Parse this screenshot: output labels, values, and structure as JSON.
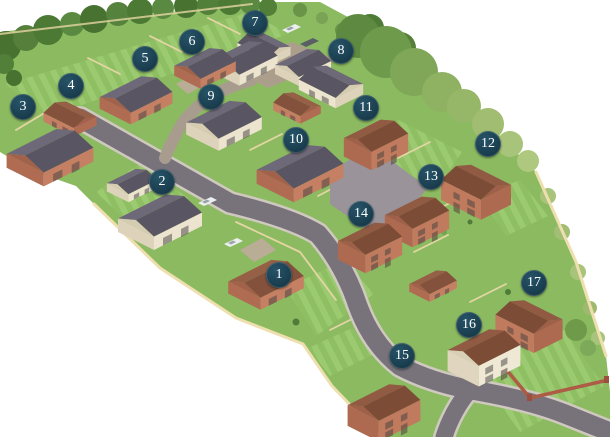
{
  "canvas": {
    "width": 610,
    "height": 437,
    "background": "#ffffff"
  },
  "site_plan": {
    "marker_style": {
      "shape": "circle",
      "diameter_px": 26,
      "background": "#1b4152",
      "highlight": "#275468",
      "rim": "#132f3c",
      "text_color": "#ffffff"
    },
    "plots": [
      {
        "number": "1",
        "x": 279,
        "y": 275
      },
      {
        "number": "2",
        "x": 162,
        "y": 182
      },
      {
        "number": "3",
        "x": 23,
        "y": 107
      },
      {
        "number": "4",
        "x": 71,
        "y": 86
      },
      {
        "number": "5",
        "x": 145,
        "y": 59
      },
      {
        "number": "6",
        "x": 192,
        "y": 42
      },
      {
        "number": "7",
        "x": 255,
        "y": 23
      },
      {
        "number": "8",
        "x": 341,
        "y": 51
      },
      {
        "number": "9",
        "x": 211,
        "y": 97
      },
      {
        "number": "10",
        "x": 296,
        "y": 140
      },
      {
        "number": "11",
        "x": 366,
        "y": 108
      },
      {
        "number": "12",
        "x": 488,
        "y": 144
      },
      {
        "number": "13",
        "x": 431,
        "y": 177
      },
      {
        "number": "14",
        "x": 361,
        "y": 214
      },
      {
        "number": "15",
        "x": 402,
        "y": 356
      },
      {
        "number": "16",
        "x": 469,
        "y": 325
      },
      {
        "number": "17",
        "x": 534,
        "y": 283
      }
    ],
    "palette": {
      "grass": "#8cba60",
      "lawn_stripe": "#9bca70",
      "road": "#78737b",
      "kerb": "#cfc9bf",
      "paving": "#9a939a",
      "courtyard": "#ab9f8c",
      "fence": "#eedfae",
      "brick_wall": "#ad5c46",
      "roof_grey": "#5a5562",
      "roof_brown": "#7d4c37",
      "brick": "#c07a5d",
      "render_cream": "#ece4cf",
      "tree_dark": "#4c7a34",
      "tree_olive": "#8fb262"
    }
  }
}
